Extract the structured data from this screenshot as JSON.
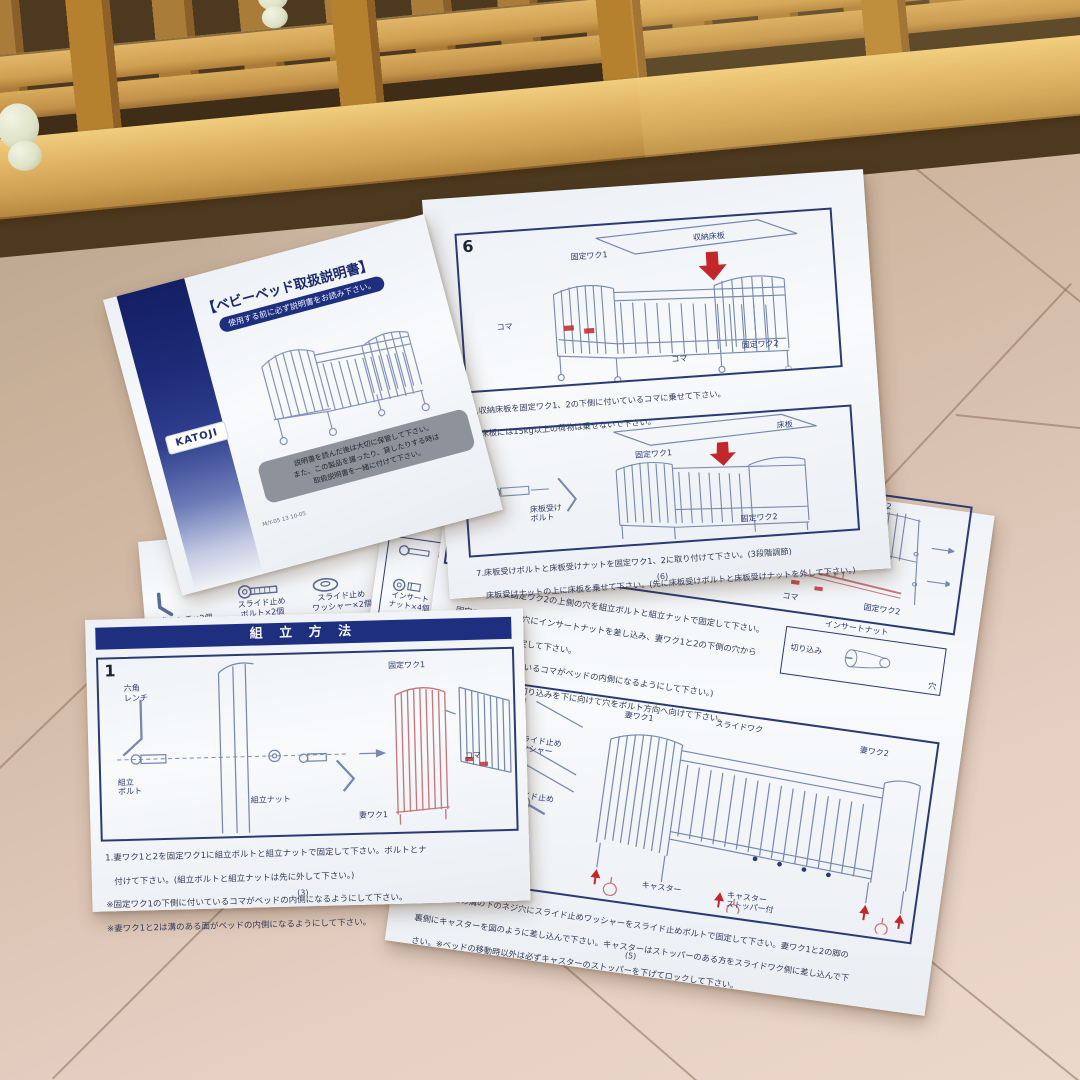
{
  "colors": {
    "print_navy": "#2c3a74",
    "red_arrow": "#c3262b",
    "red_part": "#c4787d",
    "paper": "#f5f7fa",
    "banner_navy": "#1e2f80",
    "wood_light": "#e2b566",
    "wood_dark": "#8a5f28",
    "floor_beige": "#d8c0ae"
  },
  "cover": {
    "brand": "KATOJI",
    "title": "【ベビーベッド取扱説明書】",
    "subtitle": "使用する前に必ず説明書をお読み下さい。",
    "note": [
      "説明書を読んだ後は大切に保管して下さい。",
      "また、この製品を譲ったり、貸したりする時は",
      "取扱説明書を一緒に付けて下さい。"
    ],
    "code": "M/Y-05 13 10-05"
  },
  "parts_strip": {
    "items": [
      {
        "icon": "hex-wrench-icon",
        "label": "六角レンチ×2個"
      },
      {
        "icon": "slide-stop-bolt-icon",
        "label": "スライド止め\nボルト×2個"
      },
      {
        "icon": "slide-stop-washer-icon",
        "label": "スライド止め\nワッシャー×2個"
      }
    ]
  },
  "parts_box": {
    "items": [
      {
        "icon": "floor-board-bolt-icon",
        "label": "床板受け"
      },
      {
        "icon": "insert-nut-part-icon",
        "label": "インサート\nナット×4個"
      },
      {
        "icon": "long-bolt-icon",
        "label": "ロングボルト"
      }
    ]
  },
  "page6": {
    "step6": {
      "num": "6",
      "labels": {
        "storage_board": "収納床板",
        "frame1": "固定ワク1",
        "koma_left": "コマ",
        "koma_bottom": "コマ",
        "frame2": "固定ワク2"
      },
      "caption": [
        "6.収納床板を固定ワク1、2の下側に付いているコマに乗せて下さい。",
        "　床板には15kg以上の荷物は乗せないで下さい。"
      ]
    },
    "step7": {
      "labels": {
        "board": "床板",
        "frame1": "固定ワク1",
        "frame2": "固定ワク2",
        "bolt": "床板受け\nボルト"
      },
      "caption": [
        "7.床板受けボルトと床板受けナットを固定ワク1、2に取り付けて下さい。(3段階調節)",
        "　床板受けナットの上に床板を乗せて下さい。(先に床板受けボルトと床板受けナットを外して下さい。)"
      ],
      "page_no": "(6)"
    }
  },
  "page3": {
    "banner": "組 立 方 法",
    "step1": {
      "num": "1",
      "labels": {
        "wrench": "六角\nレンチ",
        "bolt": "組立\nボルト",
        "nut": "組立ナット",
        "frame1": "固定ワク1",
        "koma": "コマ",
        "panel1": "妻ワク1"
      },
      "caption": [
        "1.妻ワク1と2を固定ワク1に組立ボルトと組立ナットで固定して下さい。ボルトとナ",
        "　付けて下さい。(組立ボルトと組立ナットは先に外して下さい。)",
        "※固定ワク1の下側に付いているコマがベッドの内側になるようにして下さい。",
        "※妻ワク1と2は溝のある面がベッドの内側になるようにして下さい。"
      ],
      "page_no": "(3)"
    }
  },
  "page5": {
    "step4": {
      "labels": {
        "long_bolt": "ロングボルト",
        "insert_nut": "インサートナット",
        "panel2": "妻ワク2",
        "koma": "コマ",
        "frame2": "固定ワク2",
        "insert_nut_box": "インサートナット",
        "notch": "切り込み",
        "hole": "穴"
      },
      "caption": [
        "4.妻ワク1と2と固定ワク2の上側の穴を組立ボルトと組立ナットで固定して下さい。",
        "　固定ワクの裏側の穴にインサートナットを差し込み、妻ワク1と2の下側の穴から",
        "　ロングボルトで固定して下さい。",
        "　(固定ワク2に付いているコマがベッドの内側になるようにして下さい。)",
        "※インサートナットは切り込みを下に向けて穴をボルト方向へ向けて下さい。"
      ]
    },
    "step5": {
      "num": "5",
      "labels": {
        "groove": "溝",
        "screw_hole": "ネジ穴",
        "leg": "脚",
        "washer": "スライド止め\nワッシャー",
        "bolt": "スライド止め\nボルト",
        "caster_left": "キャスター",
        "panel1": "妻ワク1",
        "slide_frame": "スライドワク",
        "panel2": "妻ワク2",
        "caster": "キャスター",
        "caster_stopper": "キャスター\nストッパー付"
      },
      "caption": [
        "5.妻ワク1と2の溝の下のネジ穴にスライド止めワッシャーをスライド止めボルトで固定して下さい。妻ワク1と2の脚の",
        "　裏側にキャスターを図のように差し込んで下さい。キャスターはストッパーのある方をスライドワク側に差し込んで下",
        "　さい。※ベッドの移動時以外は必ずキャスターのストッパーを下げてロックして下さい。"
      ],
      "page_no": "(5)"
    }
  }
}
